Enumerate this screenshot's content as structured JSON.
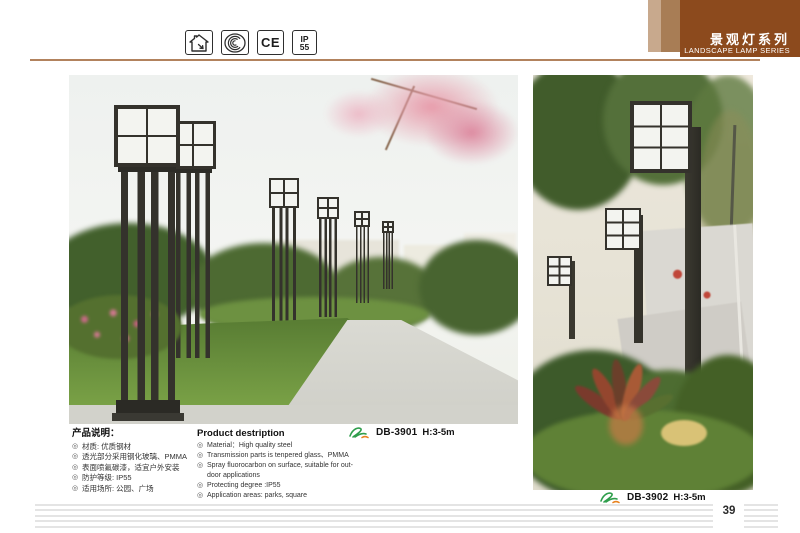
{
  "header": {
    "title_cn": "景观灯系列",
    "title_en": "LANDSCAPE LAMP SERIES",
    "colors": {
      "dark": "#8c4a1d",
      "medium": "#a87d55",
      "light": "#c8a98d",
      "rule": "#b2825d"
    }
  },
  "certifications": {
    "ce_label": "CE",
    "ip_line1": "IP",
    "ip_line2": "55"
  },
  "bullet_char": "◎",
  "description_cn": {
    "heading": "产品说明：",
    "items": [
      "材质: 优质钢材",
      "透光部分采用钢化玻璃、PMMA",
      "表面喷氟碳漆，适宜户外安装",
      "防护等级: IP55",
      "适用场所: 公园、广场"
    ]
  },
  "description_en": {
    "heading": "Product destription",
    "items": [
      "Material：High quality steel",
      "Transmission parts is tenpered glass、PMMA",
      "Spray fluorocarbon on surface, suitable for out-door applications",
      "Protecting degree :IP55",
      "Application areas: parks, square"
    ]
  },
  "products": [
    {
      "model": "DB-3901",
      "height": "H:3-5m"
    },
    {
      "model": "DB-3902",
      "height": "H:3-5m"
    }
  ],
  "page_number": "39"
}
